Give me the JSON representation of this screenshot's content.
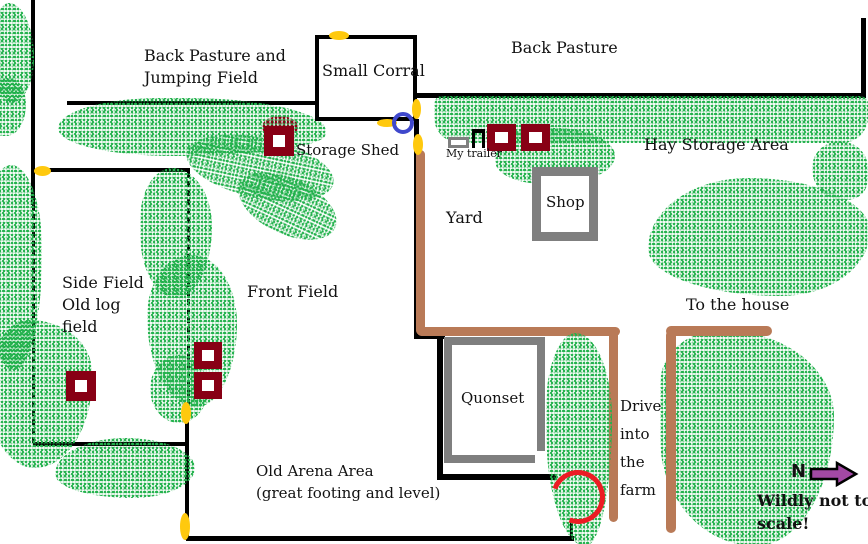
{
  "labels": {
    "back_pasture_jumping_1": "Back Pasture and",
    "back_pasture_jumping_2": "Jumping Field",
    "small_corral": "Small Corral",
    "back_pasture": "Back Pasture",
    "storage_shed": "Storage Shed",
    "my_trailer": "My trailer",
    "hay_storage": "Hay Storage Area",
    "yard": "Yard",
    "shop": "Shop",
    "side_field_1": "Side Field",
    "side_field_2": "Old log",
    "side_field_3": "field",
    "front_field": "Front Field",
    "to_the_house": "To the house",
    "quonset": "Quonset",
    "drive_1": "Drive",
    "drive_2": "into",
    "drive_3": "the",
    "drive_4": "farm",
    "old_arena_1": "Old Arena Area",
    "old_arena_2": "(great footing and level)",
    "north": "N",
    "not_to_scale_1": "Wildly not to",
    "not_to_scale_2": "scale!"
  },
  "colors": {
    "background": "#FFFFFF",
    "fence_black": "#000000",
    "tree_green": "#22B14C",
    "jump_maroon": "#880015",
    "gate_yellow": "#FFC90E",
    "drive_brown": "#B97A57",
    "building_gray": "#7F7F7F",
    "gate_circle_blue": "#3F48CC",
    "turnaround_red": "#EC1C24",
    "north_arrow_purple": "#A349A4"
  },
  "icons": {
    "north_arrow": "block-arrow-right",
    "gates": "yellow-oval-gate-marker",
    "jumps": "maroon-square-jump",
    "trees": "green-spray-vegetation"
  }
}
